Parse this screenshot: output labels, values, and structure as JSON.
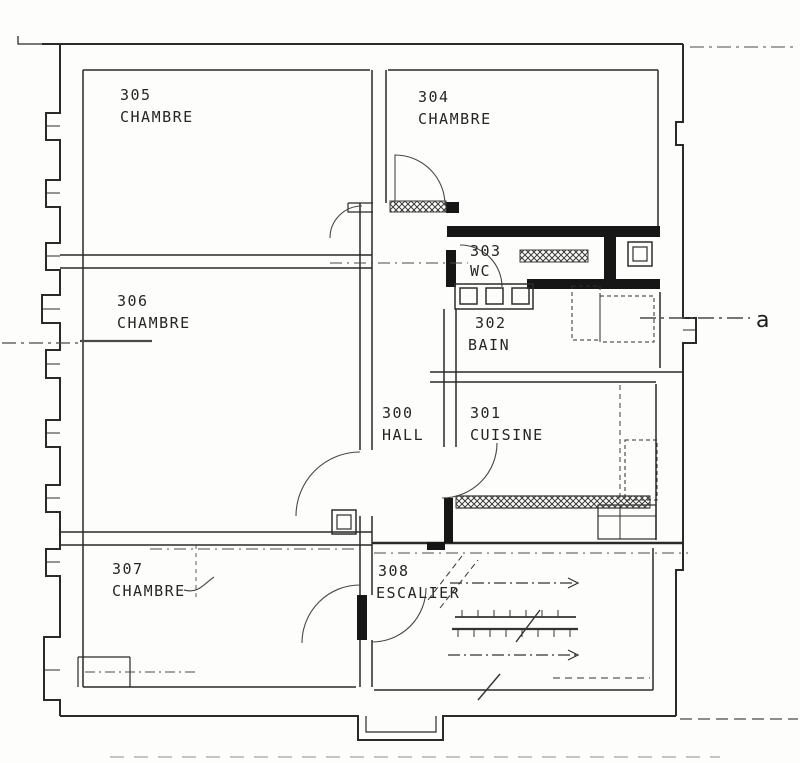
{
  "plan": {
    "ink_color": "#262626",
    "paper_color": "#fdfdfb",
    "section_marker": {
      "label": "a"
    },
    "rooms": [
      {
        "number": "305",
        "name": "CHAMBRE"
      },
      {
        "number": "304",
        "name": "CHAMBRE"
      },
      {
        "number": "303",
        "name": "WC"
      },
      {
        "number": "306",
        "name": "CHAMBRE"
      },
      {
        "number": "302",
        "name": "BAIN"
      },
      {
        "number": "300",
        "name": "HALL"
      },
      {
        "number": "301",
        "name": "CUISINE"
      },
      {
        "number": "307",
        "name": "CHAMBRE"
      },
      {
        "number": "308",
        "name": "ESCALIER"
      }
    ]
  }
}
